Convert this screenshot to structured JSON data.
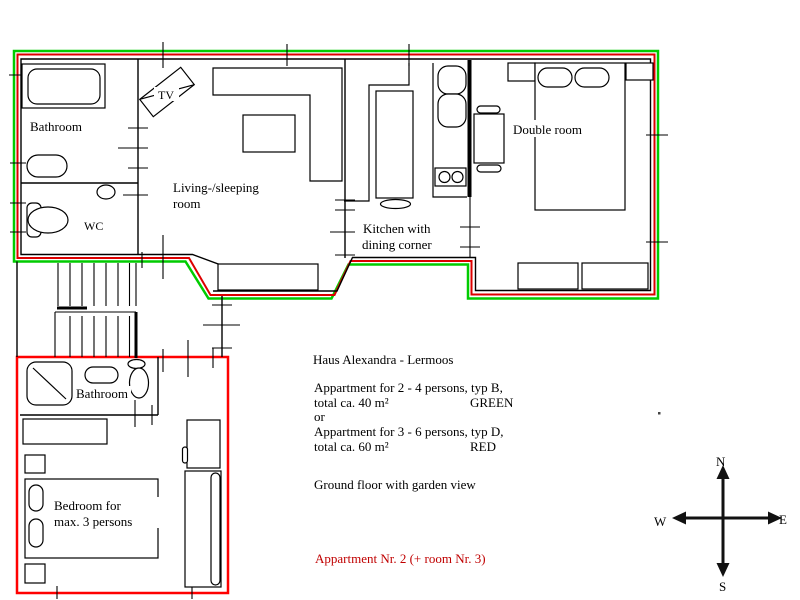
{
  "colors": {
    "background": "#ffffff",
    "outline_green": "#00cc00",
    "outline_red": "#dd0000",
    "outline_red_bright": "#ff0000",
    "wall": "#000000",
    "note_red": "#c00000"
  },
  "rooms": {
    "bathroom_upper": "Bathroom",
    "wc": "WC",
    "tv": "TV",
    "living_line1": "Living-/sleeping",
    "living_line2": "room",
    "kitchen_line1": "Kitchen with",
    "kitchen_line2": "dining corner",
    "double_room": "Double room",
    "bathroom_lower": "Bathroom",
    "bedroom_line1": "Bedroom for",
    "bedroom_line2": "max. 3 persons"
  },
  "legend": {
    "heading": "Haus Alexandra - Lermoos",
    "apartment_b_line1": "Appartment for 2 - 4 persons, typ B,",
    "apartment_b_line2": "total ca. 40 m²",
    "apartment_b_color": "GREEN",
    "or": "or",
    "apartment_d_line1": "Appartment for 3 - 6 persons, typ D,",
    "apartment_d_line2": "total ca. 60 m²",
    "apartment_d_color": "RED",
    "floor_note": "Ground floor with garden view",
    "apartment_note": "Appartment Nr. 2 (+ room Nr. 3)"
  },
  "compass": {
    "north": "N",
    "south": "S",
    "west": "W",
    "east": "E"
  }
}
